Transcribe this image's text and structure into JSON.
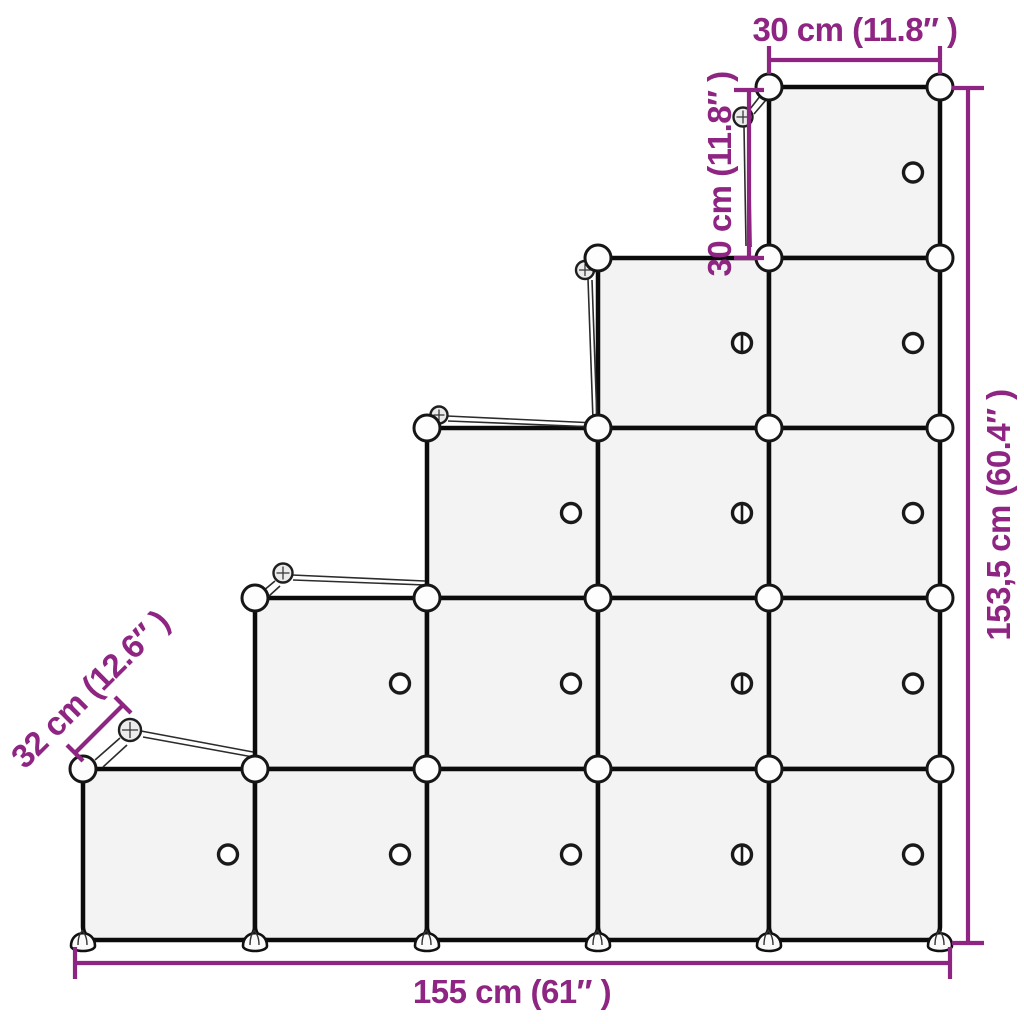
{
  "title": "Cube storage organizer staircase — dimension diagram",
  "dimensions": {
    "top_width": "30 cm (11.8″ )",
    "upper_cube_height": "30 cm (11.8″ )",
    "total_height": "153,5 cm (60.4″ )",
    "total_width": "155 cm (61″ )",
    "depth": "32 cm (12.6″ )"
  },
  "structure": {
    "rows": 5,
    "total_cubes": 15,
    "columns": [
      {
        "cubes": 1,
        "knob": "round"
      },
      {
        "cubes": 2,
        "knob": "round"
      },
      {
        "cubes": 3,
        "knob": "round"
      },
      {
        "cubes": 4,
        "knob": "slotted"
      },
      {
        "cubes": 5,
        "knob": "round"
      }
    ]
  },
  "colors": {
    "accent": "#8e2582",
    "cube_fill": "#f3f3f3",
    "line": "#0b0b0b",
    "background": "#ffffff"
  }
}
